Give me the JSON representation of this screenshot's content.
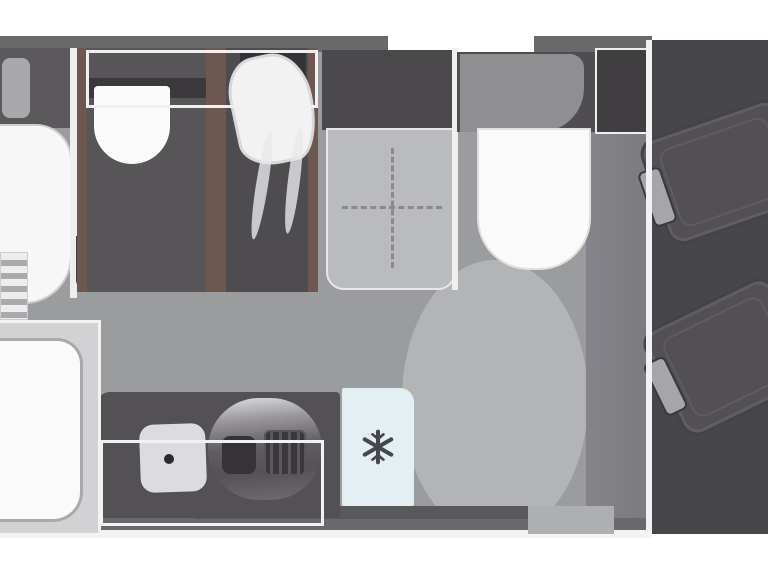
{
  "title": "Motorhome floor plan (top view)",
  "diagram": {
    "type": "floorplan",
    "subject": "motorhome interior, horizontal top-view layout, cab on the right",
    "areas": [
      {
        "id": "rear-bed",
        "label": "rear bed with pillow"
      },
      {
        "id": "bed-steps",
        "label": "bed access steps"
      },
      {
        "id": "bathroom",
        "label": "washroom with basin"
      },
      {
        "id": "shower",
        "label": "shower cubicle with glass door"
      },
      {
        "id": "dinette",
        "label": "dinette table with folding-leaf marker"
      },
      {
        "id": "travel-seat",
        "label": "forward-facing bench seat"
      },
      {
        "id": "wardrobe",
        "label": "wardrobe cabinet"
      },
      {
        "id": "front-bed",
        "label": "front bed / sofa"
      },
      {
        "id": "kitchen",
        "label": "kitchen block with sink and hob"
      },
      {
        "id": "fridge",
        "label": "fridge-freezer"
      },
      {
        "id": "entrance",
        "label": "entrance area with door swing"
      },
      {
        "id": "cab",
        "label": "driver cab with two swivel seats"
      }
    ],
    "icons": {
      "fridge_freezer": "snowflake-icon"
    },
    "colors": {
      "background": "#ffffff",
      "floor": "#9b9c9e",
      "floor_light": "#b3b4b6",
      "wall_dark": "#69686b",
      "wall_light": "#f2f2f2",
      "room_dark": "#575558",
      "cab_dark": "#47464a",
      "cushion_white": "#fafafa",
      "table_gray": "#babbbd",
      "frame_brown": "#6e5750",
      "fridge_blue": "#e4eff3",
      "snowflake": "#47464a"
    }
  }
}
